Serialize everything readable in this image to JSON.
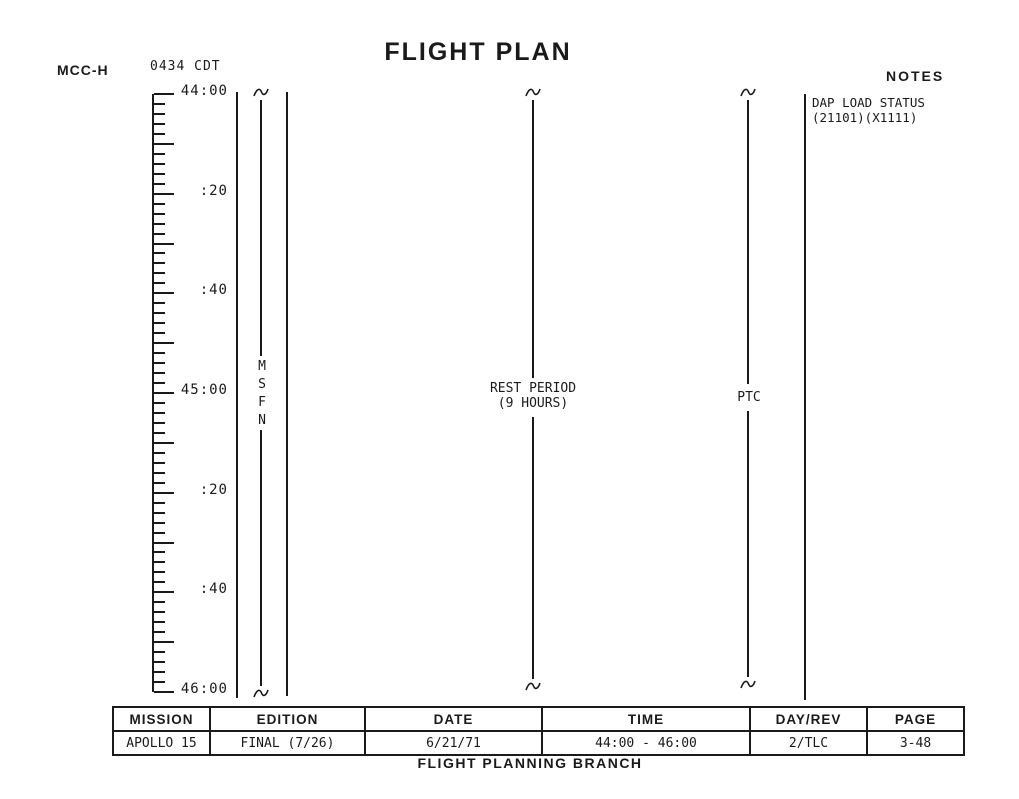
{
  "page": {
    "title": "FLIGHT PLAN",
    "station_label": "MCC-H",
    "local_time": "0434 CDT",
    "notes_heading": "NOTES",
    "footer": "FLIGHT PLANNING BRANCH"
  },
  "timeline": {
    "start_label": "44:00",
    "end_label": "46:00",
    "total_minutes": 120,
    "minor_tick_minutes": 2,
    "major_tick_minutes": 10,
    "labels": [
      {
        "text": "44:00",
        "minutes": 0
      },
      {
        "text": ":20",
        "minutes": 20
      },
      {
        "text": ":40",
        "minutes": 40
      },
      {
        "text": "45:00",
        "minutes": 60
      },
      {
        "text": ":20",
        "minutes": 80
      },
      {
        "text": ":40",
        "minutes": 100
      },
      {
        "text": "46:00",
        "minutes": 120
      }
    ]
  },
  "annotations": {
    "msfn": [
      "M",
      "S",
      "F",
      "N"
    ],
    "rest_period_line1": "REST PERIOD",
    "rest_period_line2": "(9 HOURS)",
    "ptc": "PTC",
    "dap_note_line1": "DAP LOAD STATUS",
    "dap_note_line2": "(21101)(X1111)"
  },
  "table": {
    "columns": [
      {
        "header": "MISSION",
        "value": "APOLLO 15"
      },
      {
        "header": "EDITION",
        "value": "FINAL (7/26)"
      },
      {
        "header": "DATE",
        "value": "6/21/71"
      },
      {
        "header": "TIME",
        "value": "44:00 - 46:00"
      },
      {
        "header": "DAY/REV",
        "value": "2/TLC"
      },
      {
        "header": "PAGE",
        "value": "3-48"
      }
    ]
  },
  "colors": {
    "ink": "#1a1a1a",
    "paper": "#ffffff"
  }
}
